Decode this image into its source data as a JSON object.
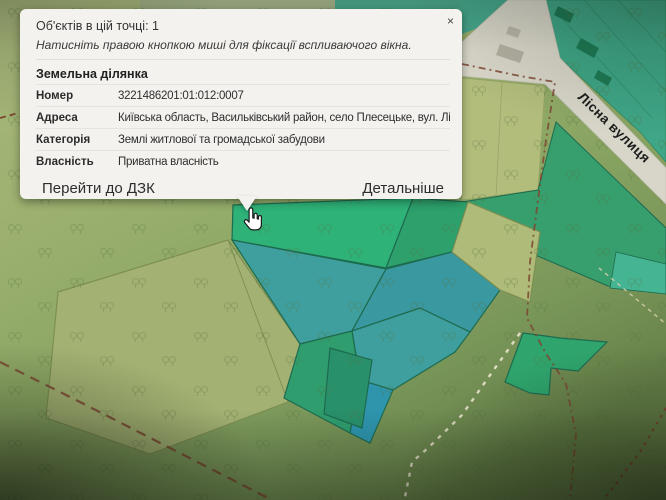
{
  "popup": {
    "header": "Об'єктів в цій точці: 1",
    "hint": "Натисніть правою кнопкою миші для фіксації вспливаючого вікна.",
    "close_glyph": "×",
    "section_title": "Земельна ділянка",
    "fields": [
      {
        "label": "Номер",
        "value": "3221486201:01:012:0007"
      },
      {
        "label": "Адреса",
        "value": "Київська область, Васильківський район, село Плесецьке, вул. Лісна, 10"
      },
      {
        "label": "Категорія",
        "value": "Землі житлової та громадської забудови"
      },
      {
        "label": "Власність",
        "value": "Приватна власність"
      }
    ],
    "actions": {
      "goto_dzk": "Перейти до ДЗК",
      "details": "Детальніше"
    }
  },
  "map": {
    "street_label": "Лісна вулиця",
    "colors": {
      "selected_parcel": "#2eb278",
      "teal_parcel": "#3f9f9e",
      "road": "#d8d6c9",
      "boundary": "#7d4632",
      "path": "#e9e3cc"
    }
  }
}
